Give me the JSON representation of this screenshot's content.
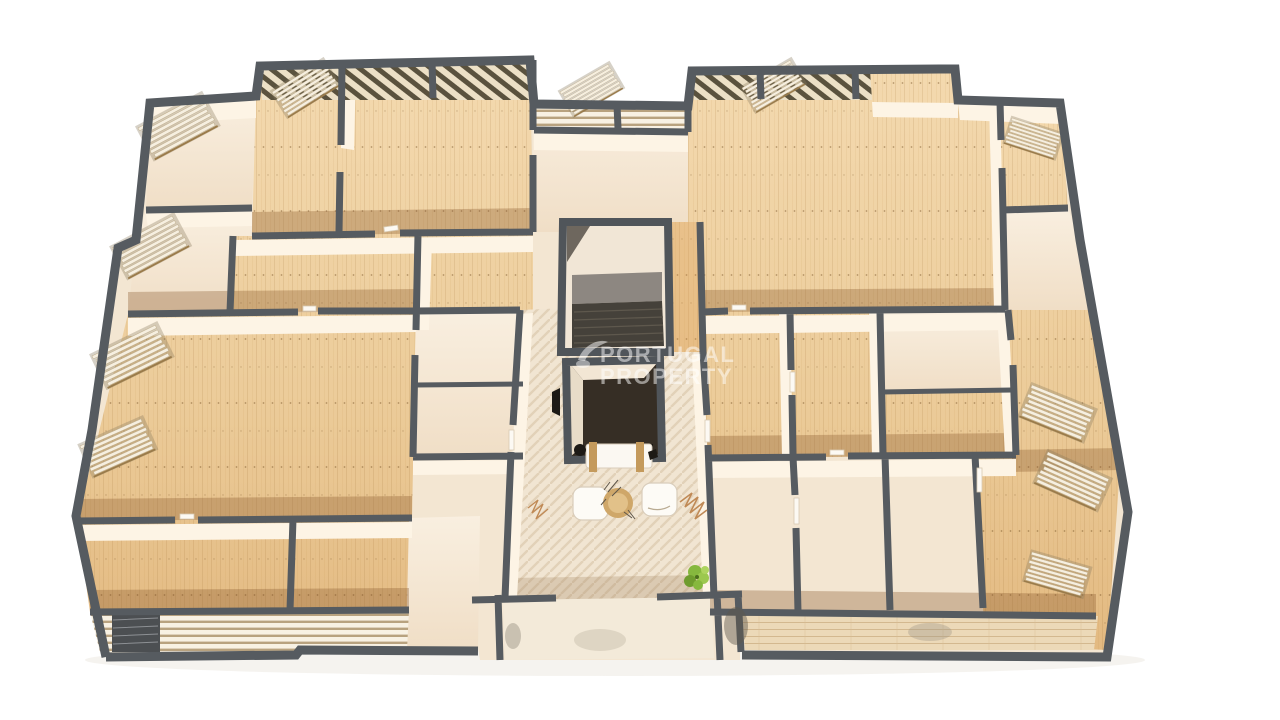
{
  "scene": {
    "description": "Top-down 3D dollhouse render of one apartment-building floor with wood-floored rooms, a central stairwell and elevator core, an entry lobby with armchairs, coffee table, bench and plant, louvered balcony shutters along the edges, on a white background"
  },
  "watermark": {
    "line1": "PORTUGAL",
    "line2": "PROPERTY"
  },
  "palette": {
    "background": "#ffffff",
    "wall_gray": "#565b60",
    "wood_light": "#f2d7ab",
    "wood_dark": "#c9914f",
    "cream_room": "#f6e8d5",
    "wall_face_cream": "#fdf4e5",
    "lobby_tile": "#f1e5d2",
    "stair_steps_dark": "#45413a",
    "stair_landing_gray": "#8d8781",
    "elevator_interior": "#362e25",
    "table_gold": "#cfa769",
    "plant_green": "#86b83e",
    "louver_slat": "#f6efe0",
    "watermark_color": "#ffffff"
  }
}
